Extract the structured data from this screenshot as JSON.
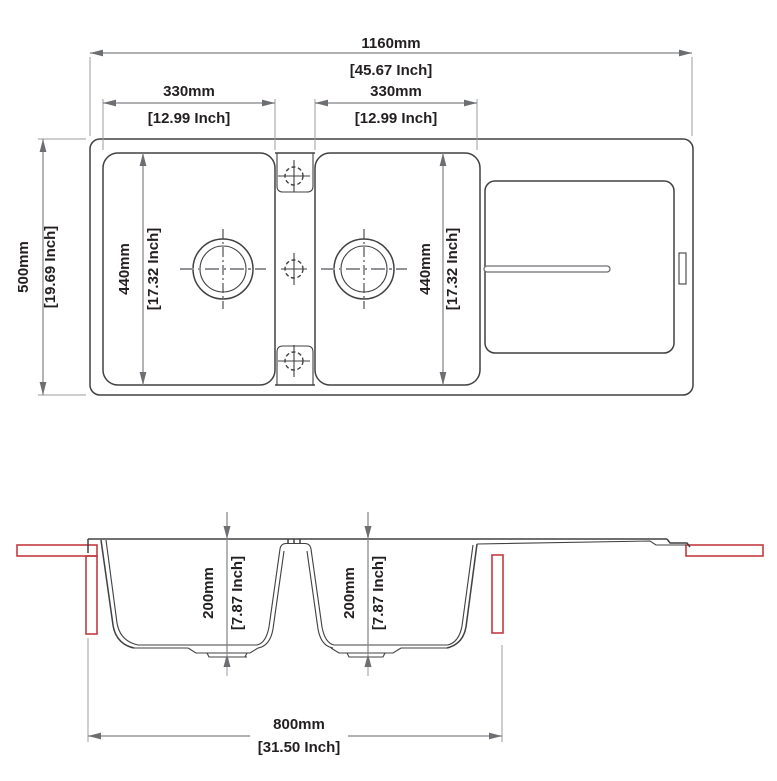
{
  "top_view": {
    "overall_width_mm": "1160mm",
    "overall_width_in": "[45.67 Inch]",
    "left_bowl_width_mm": "330mm",
    "left_bowl_width_in": "[12.99 Inch]",
    "right_bowl_width_mm": "330mm",
    "right_bowl_width_in": "[12.99 Inch]",
    "overall_depth_mm": "500mm",
    "overall_depth_in": "[19.69 Inch]",
    "left_bowl_length_mm": "440mm",
    "left_bowl_length_in": "[17.32 Inch]",
    "right_bowl_length_mm": "440mm",
    "right_bowl_length_in": "[17.32 Inch]"
  },
  "section_view": {
    "left_bowl_depth_mm": "200mm",
    "left_bowl_depth_in": "[7.87 Inch]",
    "right_bowl_depth_mm": "200mm",
    "right_bowl_depth_in": "[7.87 Inch]",
    "bowl_span_mm": "800mm",
    "bowl_span_in": "[31.50 Inch]"
  },
  "colors": {
    "drawing_line": "#414042",
    "dimension_line": "#808285",
    "text": "#231f20",
    "countertop_red": "#c23b41"
  }
}
